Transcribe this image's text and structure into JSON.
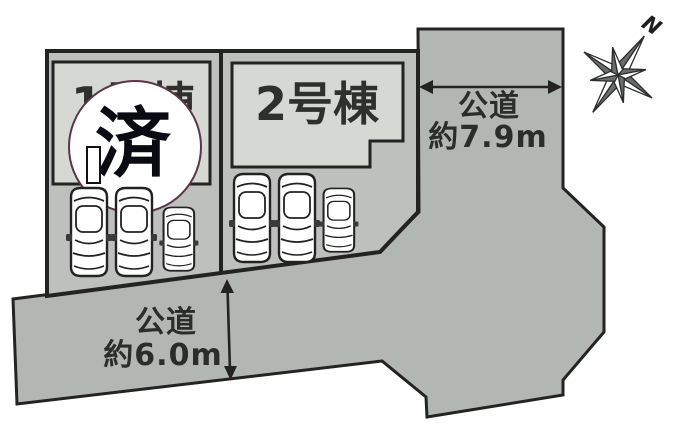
{
  "site": {
    "building1": {
      "label": "1号棟",
      "status_mark": "済"
    },
    "building2": {
      "label": "2号棟"
    },
    "road_right": {
      "name": "公道",
      "width": "約7.9m"
    },
    "road_bottom": {
      "name": "公道",
      "width": "約6.0m"
    },
    "compass": {
      "north_label": "N"
    },
    "colors": {
      "road_fill": "#b3b7b3",
      "plot_fill": "#bdc0bd",
      "building_fill": "#d6d8d4",
      "outline": "#232323",
      "sold_circle_border": "#5c3448",
      "compass_dark": "#6a6e6a"
    }
  }
}
